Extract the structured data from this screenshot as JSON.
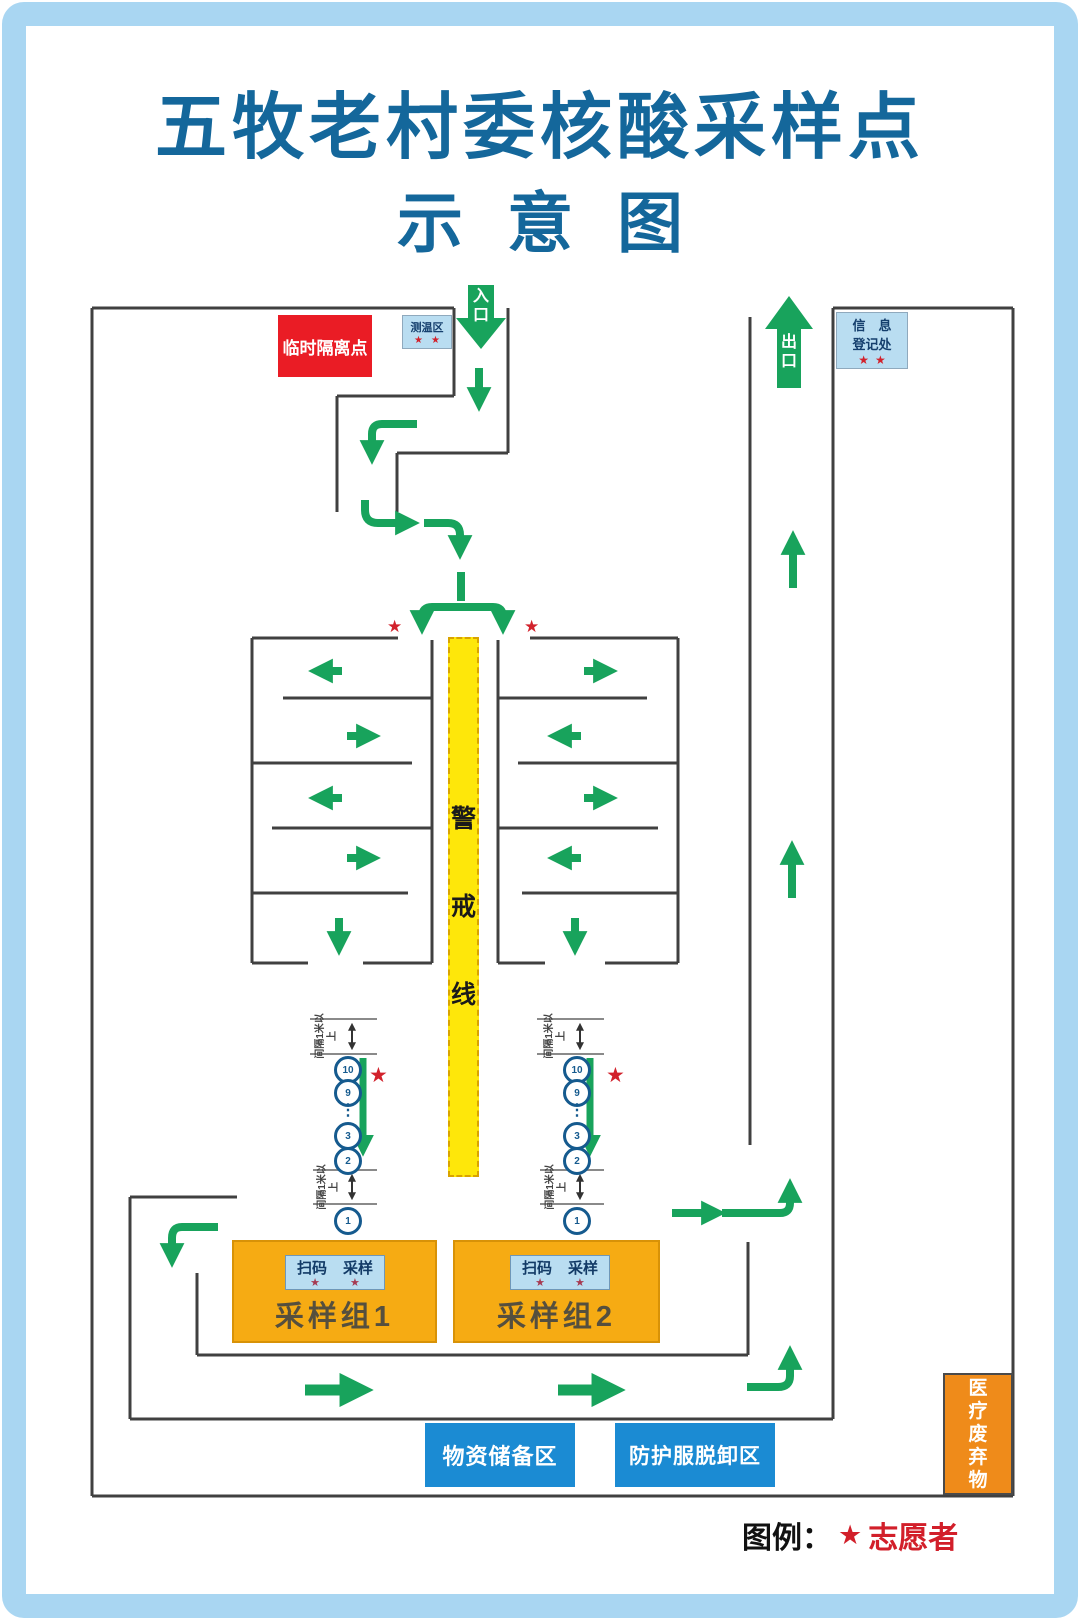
{
  "title": {
    "line1": "五牧老村委核酸采样点",
    "line2": "示意图"
  },
  "labels": {
    "entrance": "入口",
    "exit": "出口",
    "isolation": "临时隔离点",
    "temp_zone": "测温区",
    "registration_line1": "信　息",
    "registration_line2": "登记处",
    "cordon": "警戒线",
    "spacing": "间隔1米以上",
    "scan": "扫码",
    "sample": "采样",
    "group1": "采样组1",
    "group2": "采样组2",
    "supplies": "物资储备区",
    "ppe_removal": "防护服脱卸区",
    "medical_waste": "医疗废弃物",
    "legend_title": "图例：",
    "legend_text": "志愿者"
  },
  "icons": {
    "star": "★"
  },
  "queue": {
    "n10": "10",
    "n9": "9",
    "dots": "⋮",
    "n3": "3",
    "n2": "2",
    "n1": "1"
  },
  "colors": {
    "title_blue": "#14679b",
    "arrow_green": "#18a35c",
    "isolation_red": "#ea1c25",
    "light_blue_box": "#b9ddf1",
    "blue_box": "#1b8bd3",
    "sampling_orange": "#f6ab13",
    "waste_orange": "#ef8b1a",
    "cordon_yellow": "#fee70a",
    "star_red": "#d2222c",
    "wall_gray": "#404040",
    "frame_blue": "#a9d6f2"
  }
}
